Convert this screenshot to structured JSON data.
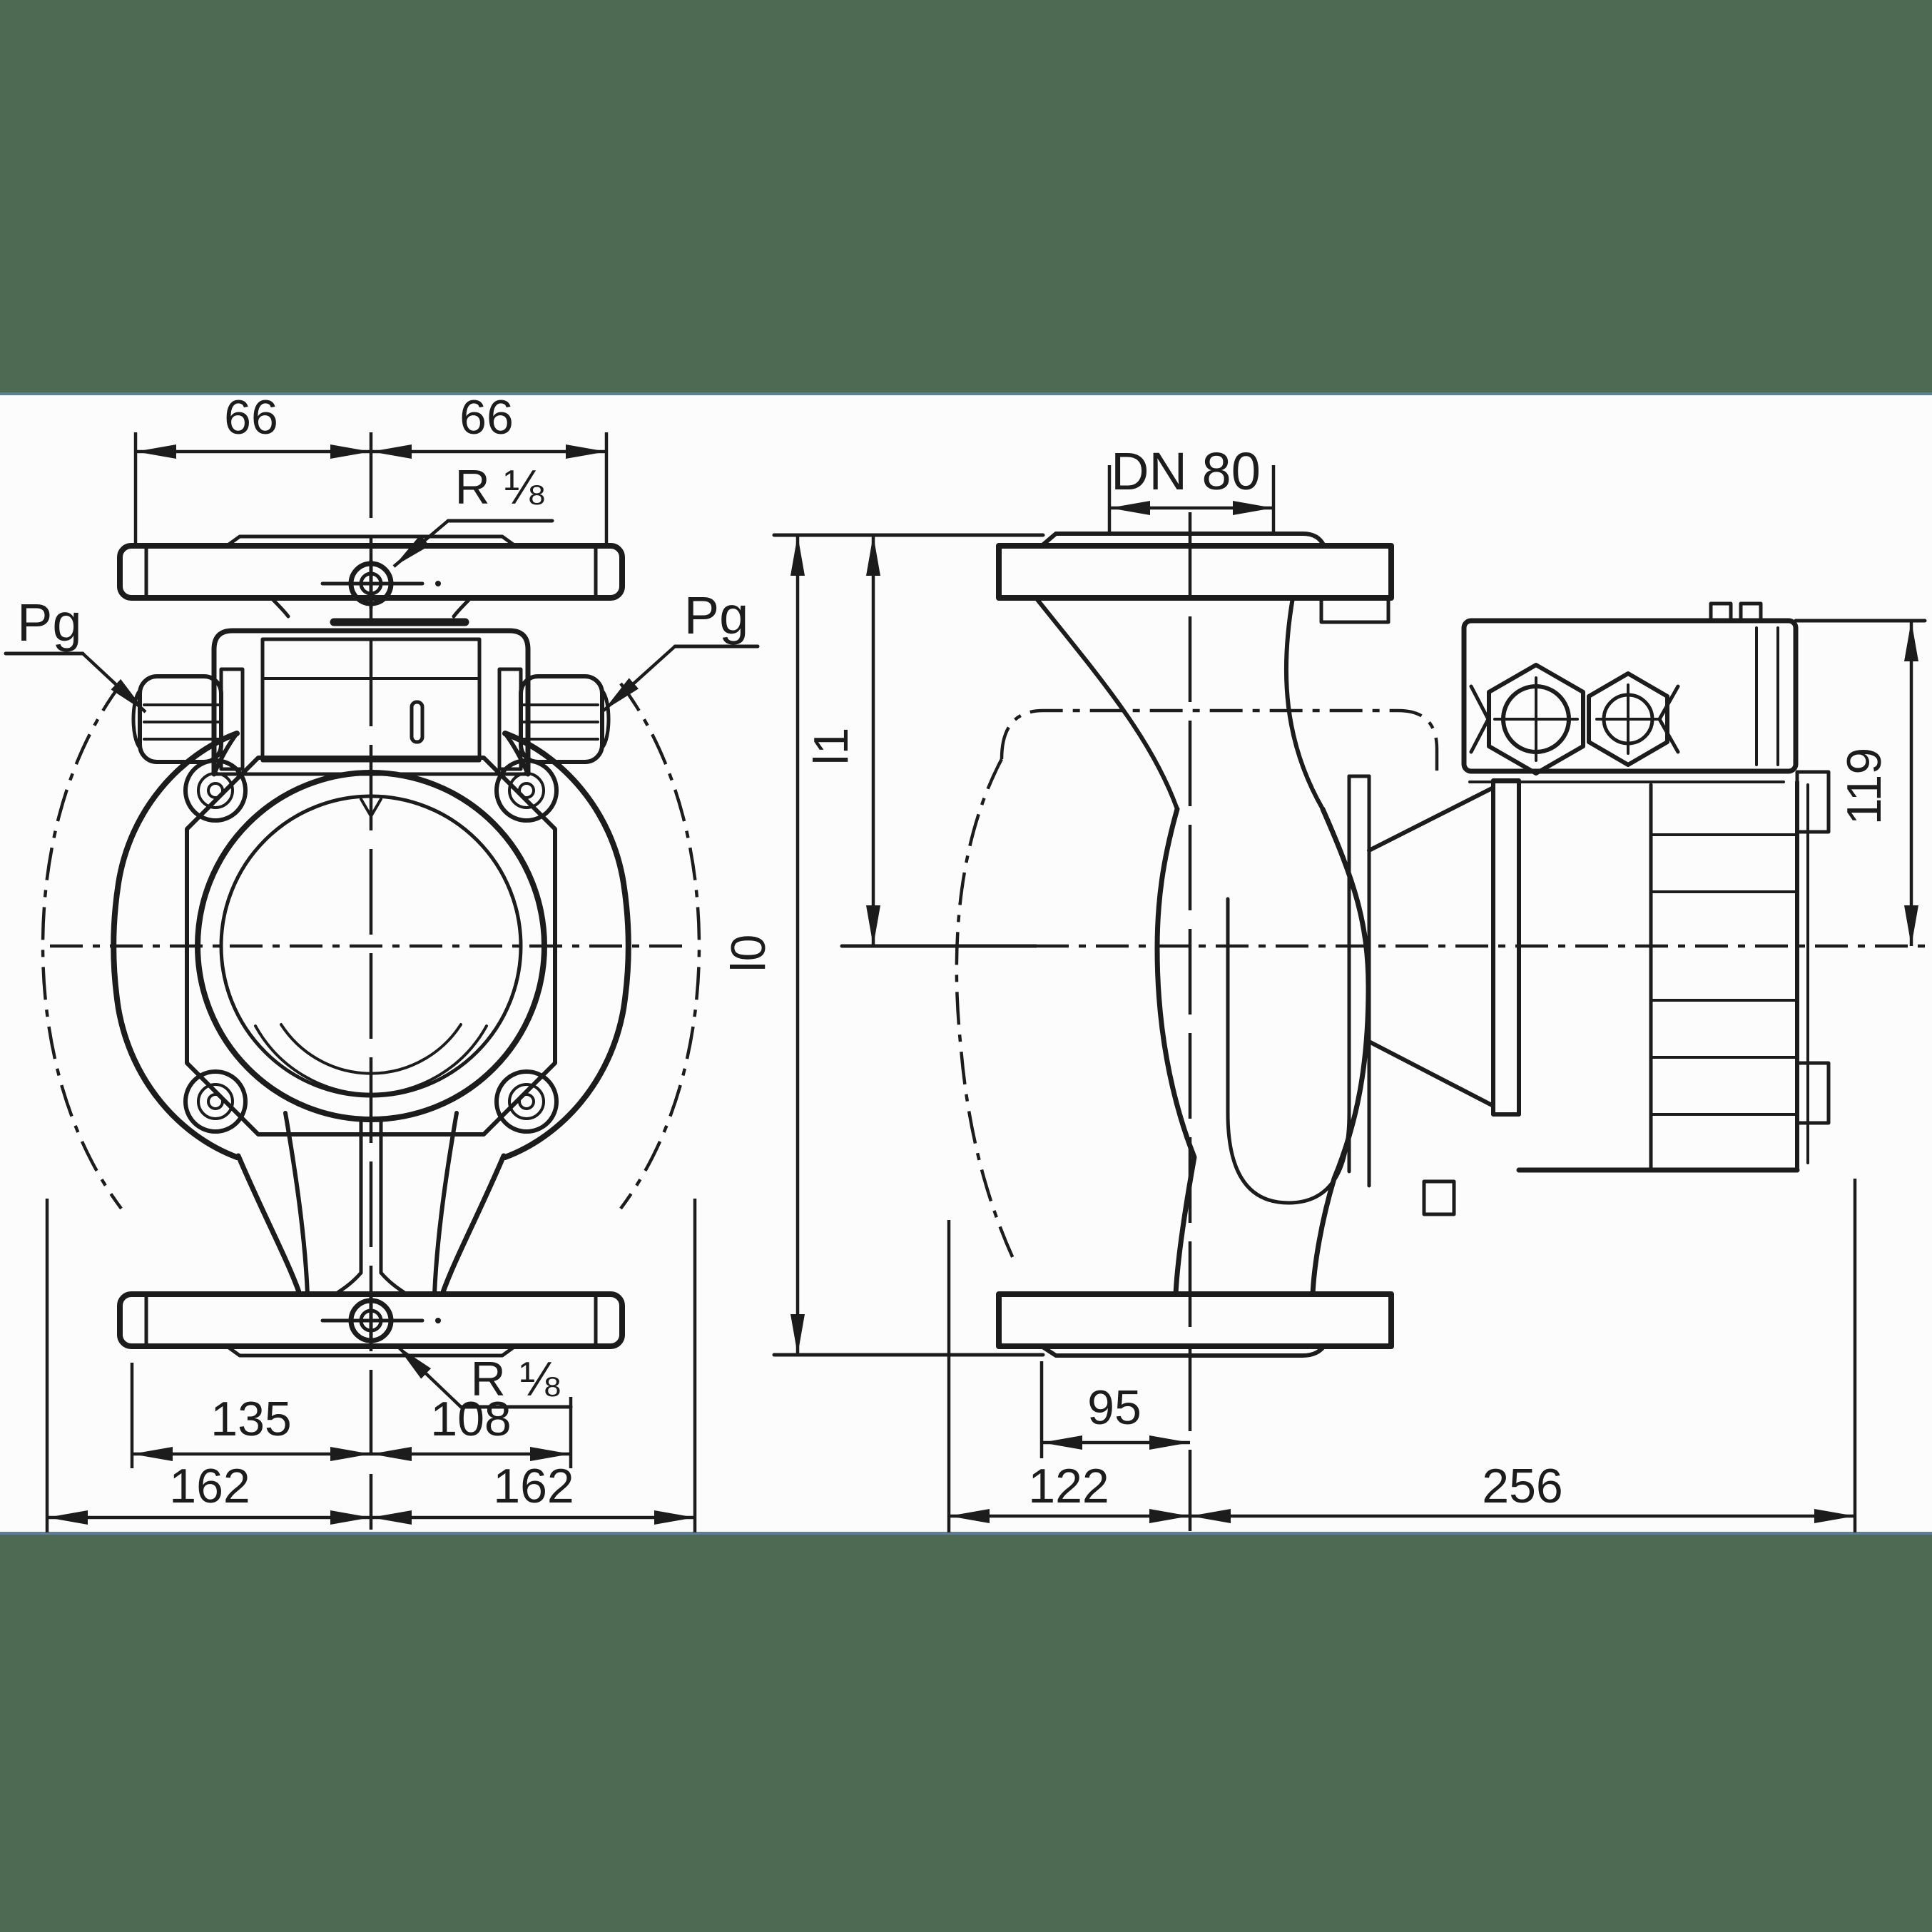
{
  "drawing": {
    "type": "technical-dimensional-drawing",
    "subject": "inline circulation pump, front view and side view",
    "background_band_color": "#4e6a52",
    "band_edge_color": "#5f7f95",
    "paper_color": "#fcfcfc",
    "ink_color": "#1c1c1c"
  },
  "labels": {
    "dim_66_left": "66",
    "dim_66_right": "66",
    "r18_top": "R ⅛",
    "r18_bottom": "R ⅛",
    "pg_left": "Pg",
    "pg_right": "Pg",
    "dn80": "DN 80",
    "l1": "l1",
    "l0": "l0",
    "dim_119": "119",
    "dim_135": "135",
    "dim_108": "108",
    "dim_162_left": "162",
    "dim_162_right": "162",
    "dim_95": "95",
    "dim_122": "122",
    "dim_256": "256"
  }
}
